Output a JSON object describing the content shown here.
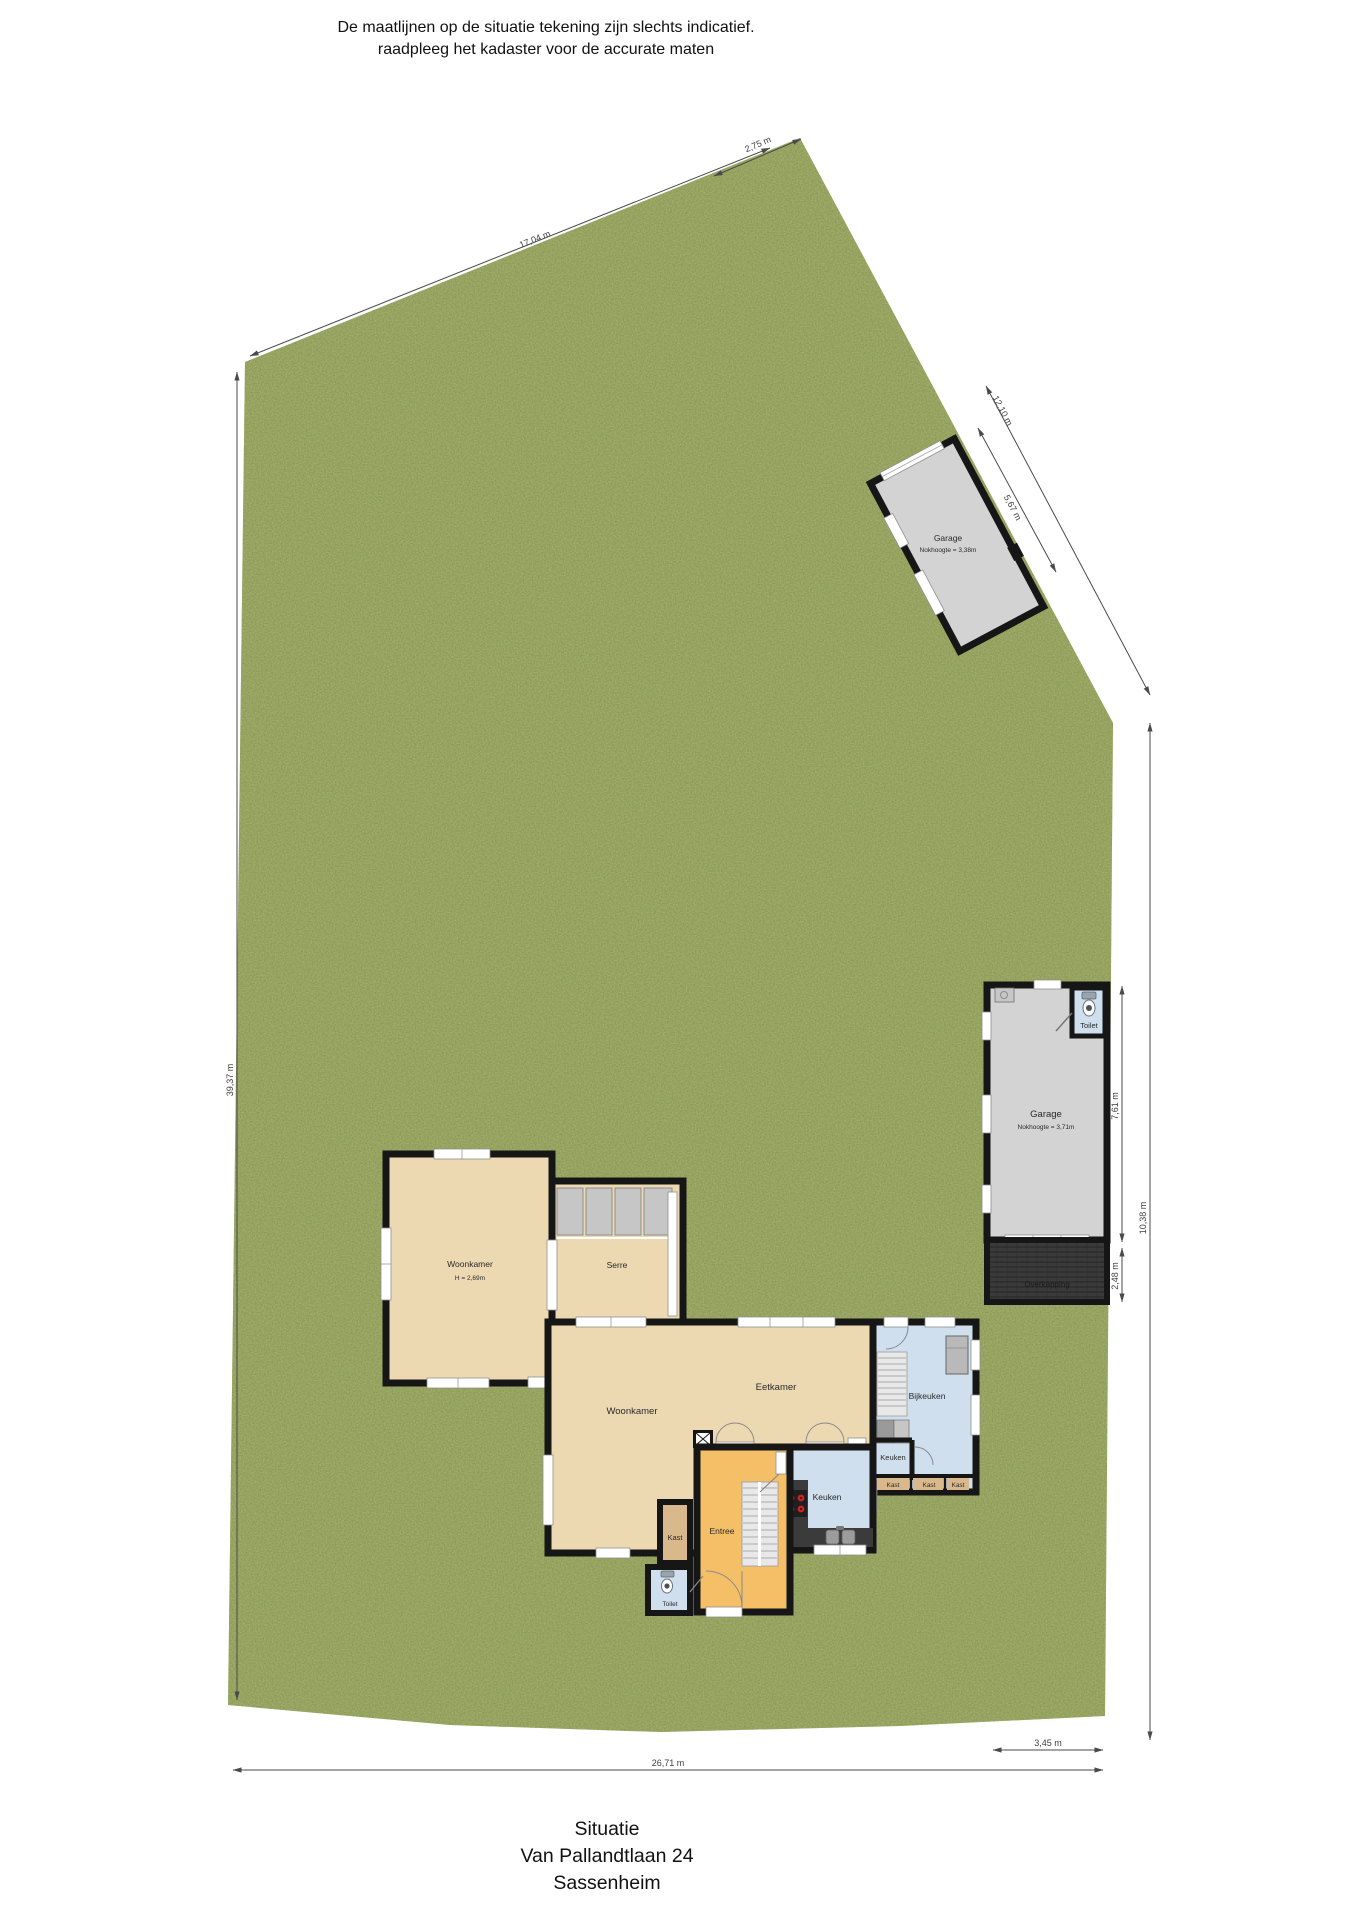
{
  "header": {
    "line1": "De maatlijnen op de situatie tekening zijn slechts indicatief.",
    "line2": "raadpleeg het kadaster voor de accurate maten"
  },
  "footer": {
    "title": "Situatie",
    "address": "Van Pallandtlaan 24",
    "city": "Sassenheim"
  },
  "dimensions": {
    "top_left_edge": "17,04 m",
    "top_corner": "2,75 m",
    "upper_right_edge": "12,10 m",
    "detached_garage_side": "5,67 m",
    "left_edge": "39,37 m",
    "bottom_edge": "26,71 m",
    "bottom_right": "3,45 m",
    "attached_garage_side": "7,61 m",
    "overkapping_depth": "2,48 m",
    "right_edge": "10,38 m"
  },
  "rooms": {
    "detached_garage": {
      "name": "Garage",
      "detail": "Nokhoogte = 3,38m"
    },
    "attached_garage": {
      "name": "Garage",
      "detail": "Nokhoogte = 3,71m"
    },
    "garage_toilet": "Toilet",
    "overkapping": "Overkapping",
    "woonkamer_upper": {
      "name": "Woonkamer",
      "detail": "H = 2,69m"
    },
    "serre": "Serre",
    "woonkamer": "Woonkamer",
    "eetkamer": "Eetkamer",
    "bijkeuken": "Bijkeuken",
    "keuken": "Keuken",
    "keuken_small": "Keuken",
    "kast_row": [
      "Kast",
      "Kast",
      "Kast"
    ],
    "entree": "Entree",
    "kast_hal": "Kast",
    "toilet_hal": "Toilet"
  },
  "colors": {
    "grass": "#7e8f49",
    "room_tan": "#ecd9b2",
    "room_tan_dark": "#d9b98c",
    "room_blue": "#cfdfee",
    "room_orange": "#f5bf68",
    "garage_gray": "#d3d3d3",
    "overkapping_dark": "#3a3a3a",
    "wall": "#161616",
    "dimension_line": "#4a4a4a"
  }
}
